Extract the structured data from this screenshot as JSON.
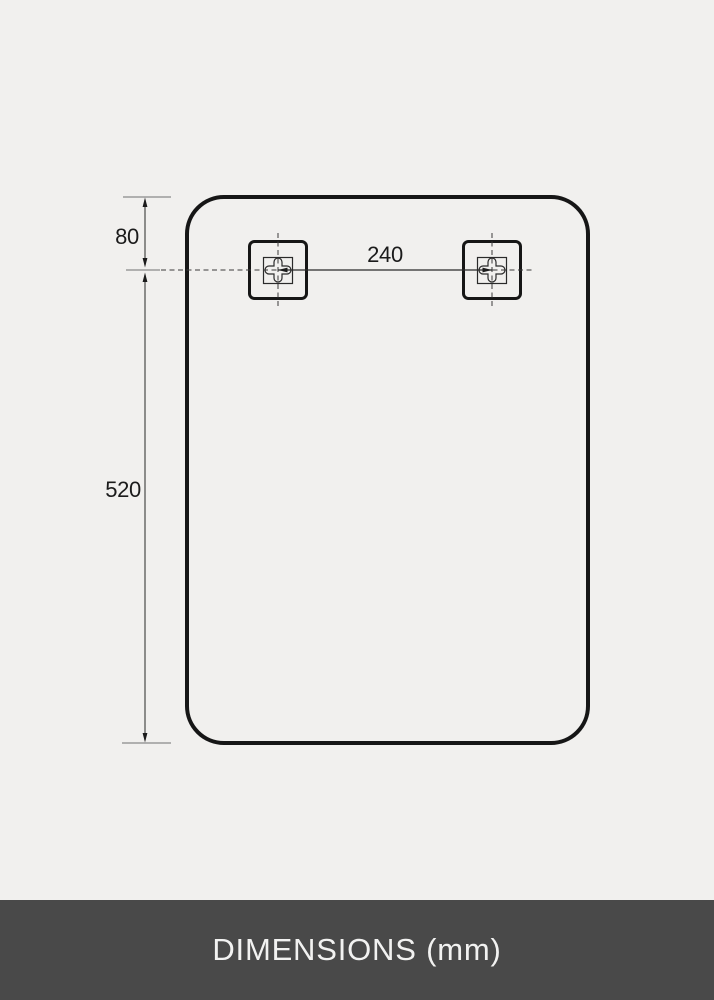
{
  "diagram": {
    "title_hint": "mirror-dimension-drawing",
    "dim_top_offset_mm": "80",
    "dim_height_mm": "520",
    "dim_bracket_spacing_mm": "240"
  },
  "footer": {
    "label": "DIMENSIONS (mm)"
  },
  "icons": {
    "bracket": "wall-mount-bracket-icon",
    "bracket_glyph": "keyhole-cross"
  },
  "colors": {
    "background": "#f1f0ee",
    "outline": "#161616",
    "dimension_line": "#3a3a3a",
    "extent_line": "#9a9a9a",
    "footer_background": "#494949",
    "footer_text": "#f2f2f1"
  }
}
